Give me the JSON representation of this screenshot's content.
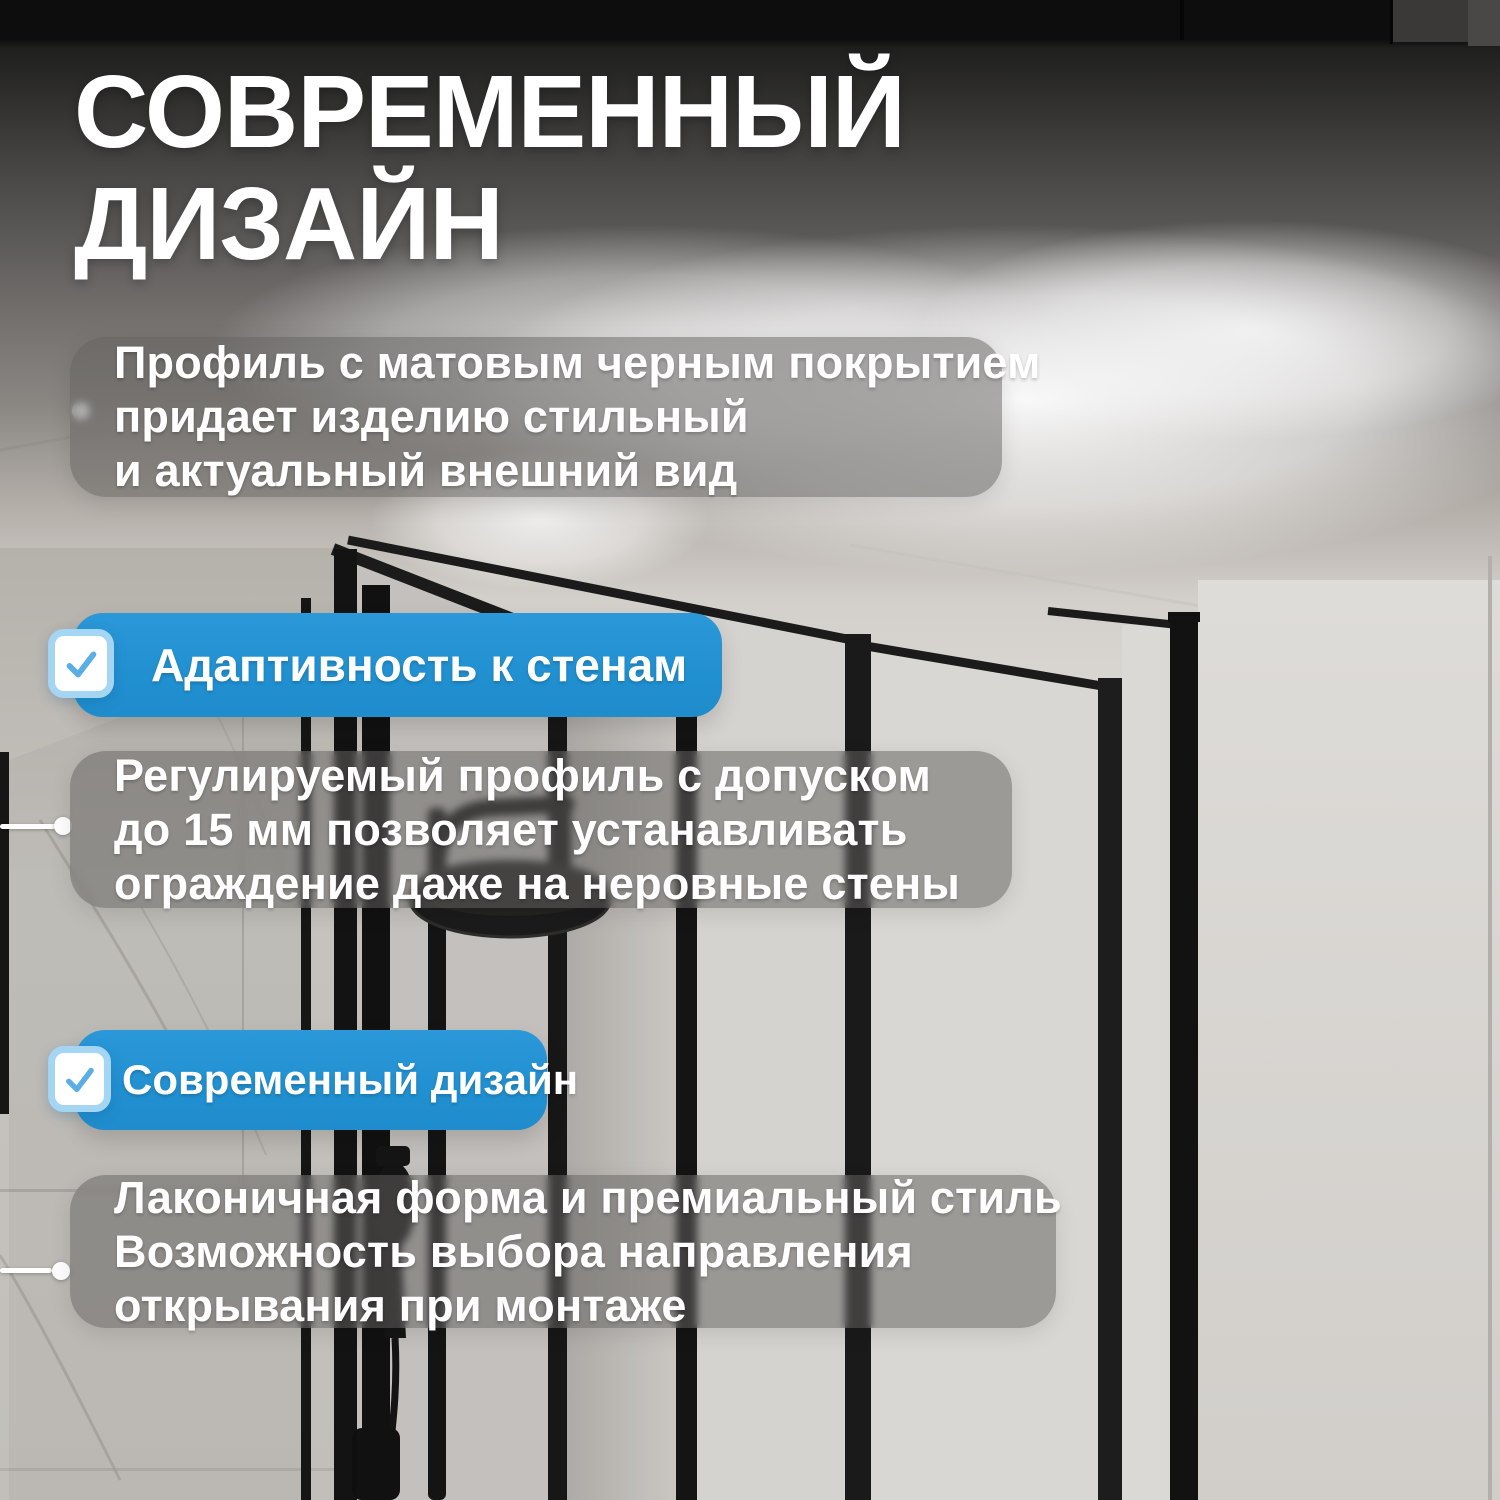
{
  "title": {
    "line1": "СОВРЕМЕННЫЙ",
    "line2": "ДИЗАЙН"
  },
  "notes": [
    {
      "lines": [
        "Профиль с матовым черным покрытием",
        "придает изделию стильный",
        "и актуальный внешний вид"
      ]
    },
    {
      "lines": [
        "Регулируемый профиль с допуском",
        "до 15 мм позволяет устанавливать",
        "ограждение даже на неровные стены"
      ]
    },
    {
      "lines": [
        "Лаконичная форма и премиальный стиль",
        "Возможность выбора направления",
        "открывания при монтаже"
      ]
    }
  ],
  "badges": [
    {
      "label": "Адаптивность к стенам"
    },
    {
      "label": "Современный дизайн"
    }
  ],
  "icons": {
    "checkbox": "checkmark-icon",
    "bullet": "dot-marker"
  },
  "colors": {
    "badge_blue": "#2492d3",
    "checkbox_ring": "#a4d6f3",
    "checkmark": "#58aee5",
    "note_bg": "rgba(100,98,95,0.52)",
    "title_text": "#ffffff",
    "frame_black": "#161616"
  }
}
